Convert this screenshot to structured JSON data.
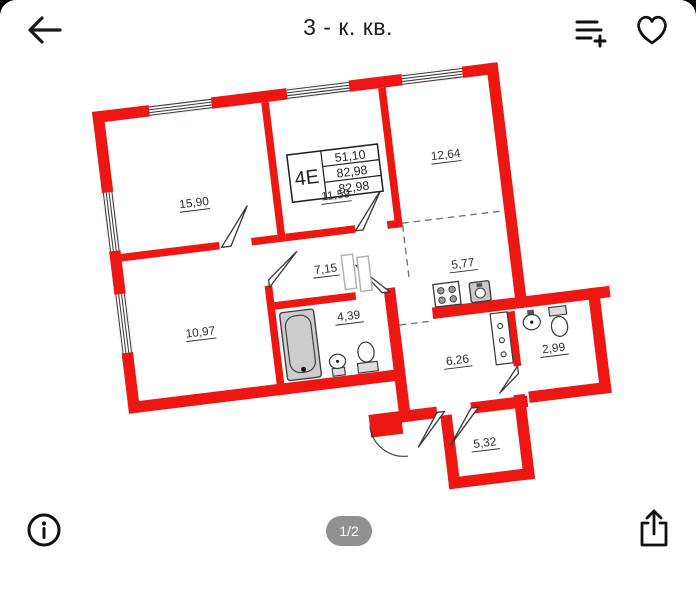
{
  "header": {
    "title": "3 - к. кв."
  },
  "footer": {
    "page_indicator": "1/2"
  },
  "plan": {
    "unit_table": {
      "type_label": "4Е",
      "rows": [
        "51,10",
        "82,98",
        "82,98"
      ]
    },
    "rooms": [
      {
        "area": "15,90"
      },
      {
        "area": "11,59"
      },
      {
        "area": "12,64"
      },
      {
        "area": "7,15"
      },
      {
        "area": "5,77"
      },
      {
        "area": "10,97"
      },
      {
        "area": "4,39"
      },
      {
        "area": "6,26"
      },
      {
        "area": "2,99"
      },
      {
        "area": "5,32"
      }
    ],
    "colors": {
      "wall": "#ee1612",
      "line": "#3a3a3a",
      "fixture_fill": "#cccccc"
    }
  },
  "icons": {
    "top": [
      "back-arrow-icon",
      "add-to-list-icon",
      "favorite-heart-icon"
    ],
    "bottom": [
      "info-icon",
      "share-icon"
    ]
  }
}
